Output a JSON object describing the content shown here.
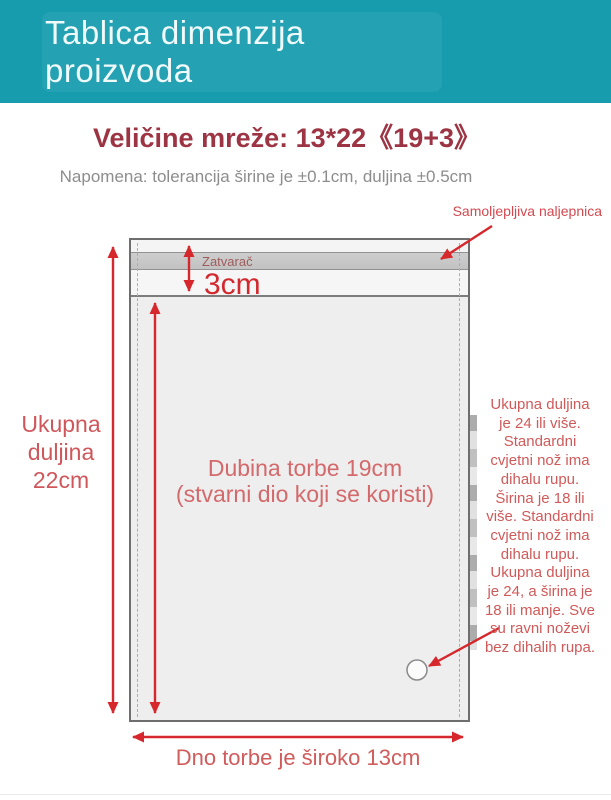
{
  "header": {
    "title": "Tablica dimenzija proizvoda"
  },
  "subtitle": "Veličine mreže: 13*22《19+3》",
  "note": "Napomena: tolerancija širine je ±0.1cm, duljina ±0.5cm",
  "diagram": {
    "sticker_label": "Samoljepljiva naljepnica",
    "zipper_label": "Zatvarač",
    "flap_height_label": "3cm",
    "total_length_label": {
      "lines": [
        "Ukupna",
        "duljina",
        "22cm"
      ]
    },
    "depth_label": {
      "lines": [
        "Dubina torbe 19cm",
        "(stvarni dio koji se koristi)"
      ]
    },
    "right_note": {
      "lines": [
        "Ukupna duljina",
        "je 24 ili više.",
        "Standardni",
        "cvjetni nož ima",
        "dihalu rupu.",
        "Širina je 18 ili",
        "više. Standardni",
        "cvjetni nož ima",
        "dihalu rupu.",
        "Ukupna duljina",
        "je 24, a širina je",
        "18 ili manje. Sve",
        "su ravni noževi",
        "bez dihalih rupa."
      ]
    },
    "bottom_width_label": "Dno torbe je široko 13cm"
  },
  "colors": {
    "header_teal": "#179cae",
    "title_maroon": "#9c3443",
    "accent_red": "#d6282c",
    "annotation_red": "#d05a5a",
    "note_gray": "#8d8d8d"
  }
}
